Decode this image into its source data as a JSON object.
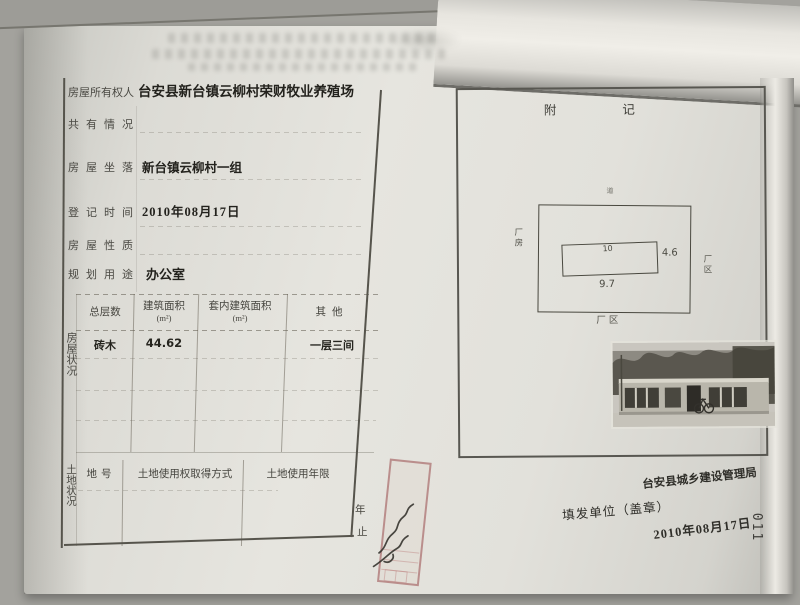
{
  "page_number": "011",
  "certificate": {
    "fields": [
      {
        "label": "房屋所有权人",
        "value": "台安县新台镇云柳村荣财牧业养殖场"
      },
      {
        "label": "共有情况",
        "value": ""
      },
      {
        "label": "房屋坐落",
        "value": "新台镇云柳村一组"
      },
      {
        "label": "登记时间",
        "value": "2010年08月17日"
      },
      {
        "label": "房屋性质",
        "value": ""
      },
      {
        "label": "规划用途",
        "value": "办公室"
      }
    ],
    "house": {
      "side_label": "房屋状况",
      "columns": [
        {
          "name": "总层数",
          "unit": ""
        },
        {
          "name": "建筑面积",
          "unit": "(m²)"
        },
        {
          "name": "套内建筑面积",
          "unit": "(m²)"
        },
        {
          "name": "其他",
          "unit": ""
        }
      ],
      "rows": [
        {
          "c0": "砖木",
          "c1": "44.62",
          "c2": "",
          "c3": "一层三间"
        }
      ]
    },
    "land": {
      "side_label": "土地状况",
      "columns": [
        "地号",
        "土地使用权取得方式",
        "土地使用年限"
      ],
      "term_top": "年",
      "term_bottom": "止"
    }
  },
  "annex": {
    "title": "附记",
    "site_plan": {
      "top_label": "道",
      "left_label": "厂房",
      "right_label": "厂区",
      "bottom_label": "厂区",
      "inner_top": "10",
      "width_label": "9.7",
      "height_label": "4.6"
    },
    "issuer": "台安县城乡建设管理局",
    "issue_unit_label": "填发单位（盖章）",
    "issue_date": "2010年08月17日"
  }
}
